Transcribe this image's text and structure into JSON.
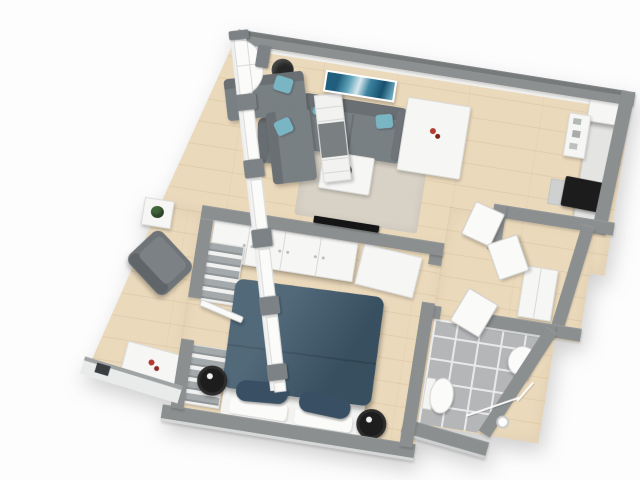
{
  "scene": {
    "title": "apartment-3d-floorplan-render",
    "view": "top-down 3d cutaway",
    "rotation_deg": 9,
    "background": "#ffffff"
  },
  "palette": {
    "wall": "#8b8f90",
    "wall_dark": "#777b7c",
    "inner_white": "#f2f3f2",
    "floor": "#ebd9bb",
    "rug": "#d8d2c6",
    "sofa": "#798084",
    "sofa_dark": "#696f72",
    "sofa_light": "#858c8f",
    "teal": "#7ab5c4",
    "bed": "#3e586b",
    "bed_pillow": "#394f63",
    "white_furniture": "#f6f6f5",
    "tile": "#b5b6b8",
    "grout": "#e9e9e9",
    "black": "#1c1c1c",
    "red": "#b23a30",
    "green": "#42663b",
    "curtain": "#7c8285",
    "counter": "#e4e4e3"
  },
  "rooms": [
    {
      "id": "living-room",
      "label": "Living Room",
      "furniture": [
        "sectional sofa with 2 teal pillows",
        "shelf unit",
        "straight sofa with 2 teal pillows",
        "gray armchair",
        "angled gray armchair",
        "white coffee table with plant",
        "beige rug",
        "black floor lamp",
        "wall-mounted tv",
        "teal abstract wall art",
        "side table with plant",
        "white desk with red decor"
      ]
    },
    {
      "id": "dining-area",
      "label": "Dining Area",
      "furniture": [
        "white dining table",
        "5 white chairs",
        "red centerpiece"
      ]
    },
    {
      "id": "kitchen",
      "label": "Kitchen",
      "furniture": [
        "tall white cabinet",
        "appliance shelf",
        "counter",
        "black cooktop"
      ]
    },
    {
      "id": "bedroom",
      "label": "Bedroom",
      "furniture": [
        "double bed with dark slate-blue duvet",
        "2 dark pillows on white base",
        "white wardrobes along wall",
        "open shelving with folded clothes",
        "2 black round bedside stools",
        "open white door"
      ]
    },
    {
      "id": "hallway",
      "label": "Hallway",
      "furniture": [
        "white wardrobe",
        "leaning white doors"
      ]
    },
    {
      "id": "bathroom",
      "label": "Bathroom",
      "furniture": [
        "gray floor tiles",
        "toilet",
        "half-round wall sink",
        "corner glass shower",
        "shower fixture"
      ]
    }
  ],
  "counts": {
    "left_wall_windows": 5,
    "arched_windows": 1,
    "dining_chairs": 5,
    "teal_throw_pillows": 4,
    "bed_pillows": 2,
    "bedside_stools": 2,
    "visible_door_leaves": 4
  }
}
